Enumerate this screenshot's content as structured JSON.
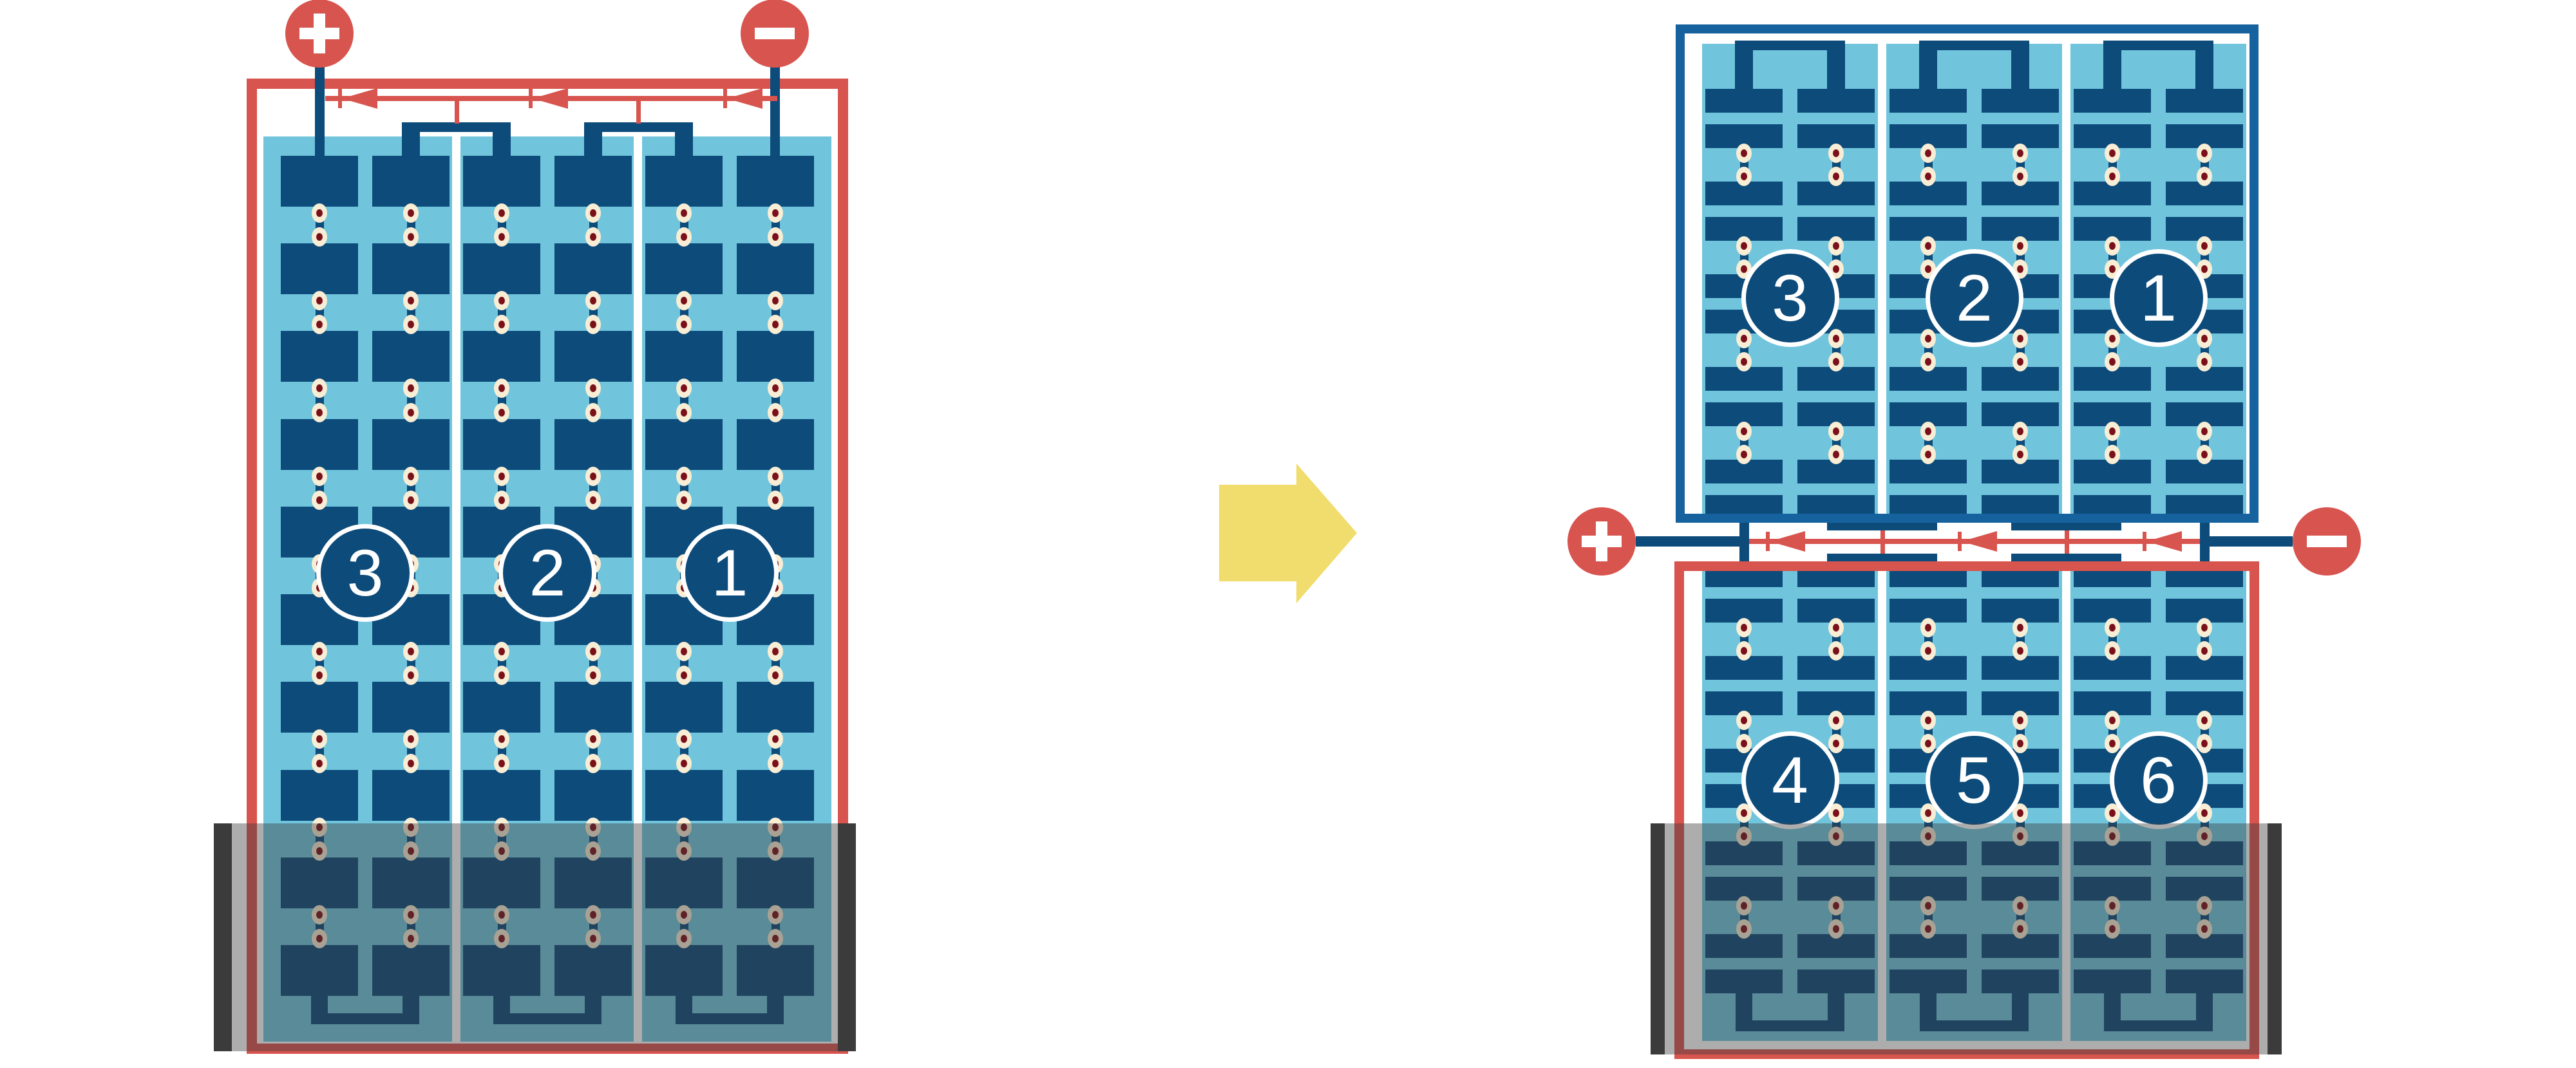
{
  "colors": {
    "circuit_red": "#D8544E",
    "cell_navy": "#0D4B7A",
    "panel_blue": "#70C5DD",
    "module_frame_blue": "#15629E",
    "solder_cream": "#F8EDD5",
    "solder_maroon": "#7A1019",
    "arrow_yellow": "#F1DC6E",
    "shade_gray": "rgba(59,59,59,0.42)",
    "shade_bar_dark": "#3B3B3B"
  },
  "icons": {
    "positive_terminal": "plus-icon",
    "negative_terminal": "minus-icon",
    "transform": "arrow-right-icon"
  },
  "left_module": {
    "substring_labels": [
      "3",
      "2",
      "1"
    ],
    "positive_terminal": "+",
    "negative_terminal": "−",
    "bypass_diode_count": 3,
    "shaded_region": "bottom"
  },
  "right_modules": {
    "top_module_labels": [
      "3",
      "2",
      "1"
    ],
    "bottom_module_labels": [
      "4",
      "5",
      "6"
    ],
    "positive_terminal": "+",
    "negative_terminal": "−",
    "bypass_diode_count": 3,
    "shaded_region": "bottom"
  }
}
